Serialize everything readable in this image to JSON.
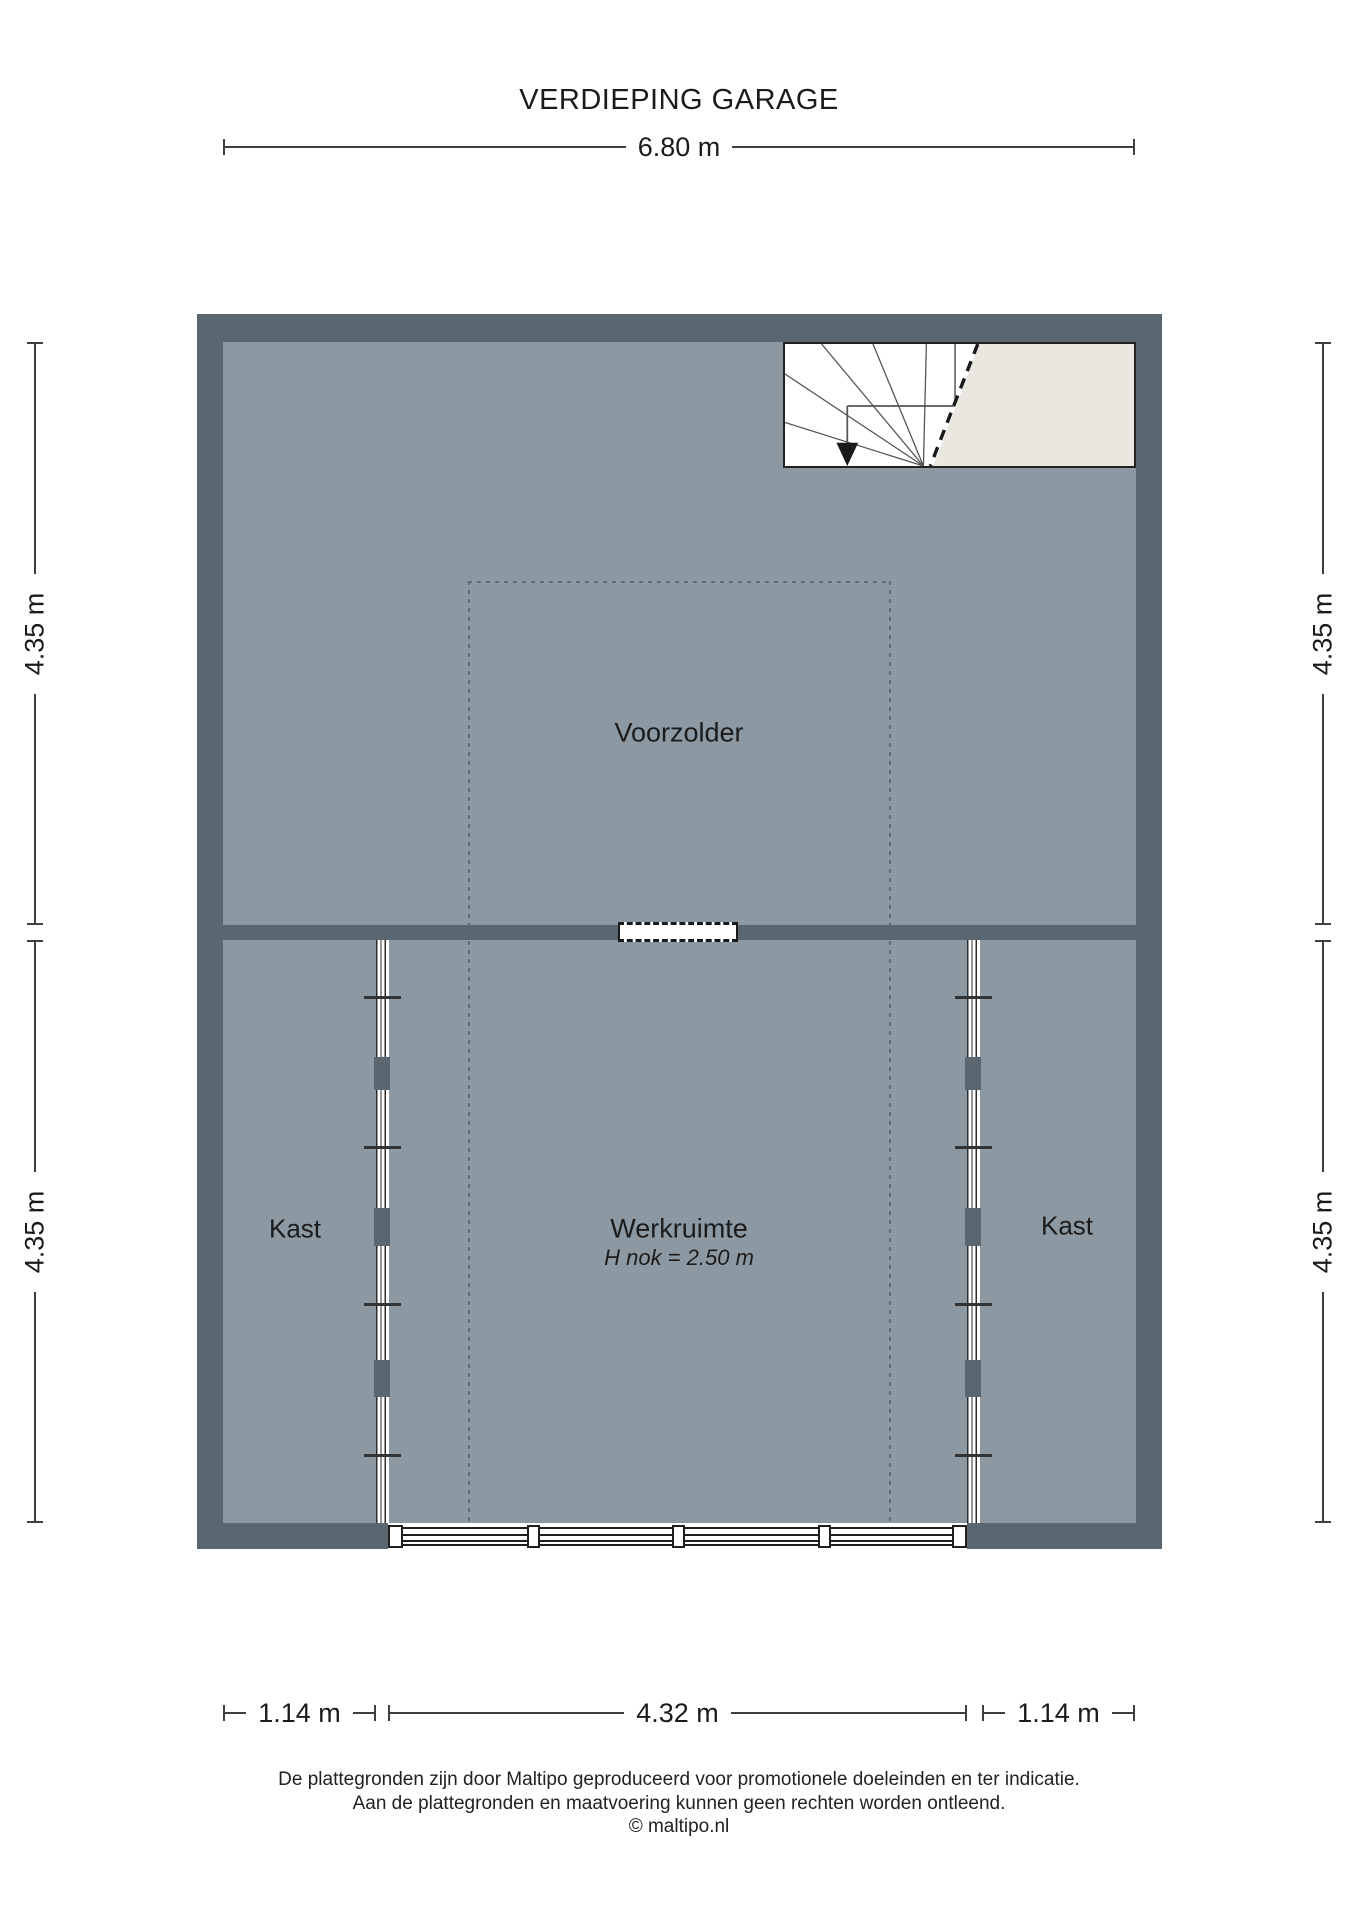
{
  "title": "VERDIEPING GARAGE",
  "rooms": {
    "voorzolder": "Voorzolder",
    "werkruimte": "Werkruimte",
    "werkruimte_sub": "H nok = 2.50 m",
    "kast_left": "Kast",
    "kast_right": "Kast"
  },
  "dimensions": {
    "top": "6.80 m",
    "left_upper": "4.35 m",
    "left_lower": "4.35 m",
    "right_upper": "4.35 m",
    "right_lower": "4.35 m",
    "bottom_left": "1.14 m",
    "bottom_middle": "4.32 m",
    "bottom_right": "1.14 m"
  },
  "footer": {
    "line1": "De plattegronden zijn door Maltipo geproduceerd voor promotionele doeleinden en ter indicatie.",
    "line2": "Aan de plattegronden en maatvoering kunnen geen rechten worden ontleend.",
    "line3": "© maltipo.nl"
  },
  "colors": {
    "wall": "#5b6770",
    "floor": "#8d99a2",
    "void": "#e9e7e0",
    "ink": "#1b1b1b"
  }
}
